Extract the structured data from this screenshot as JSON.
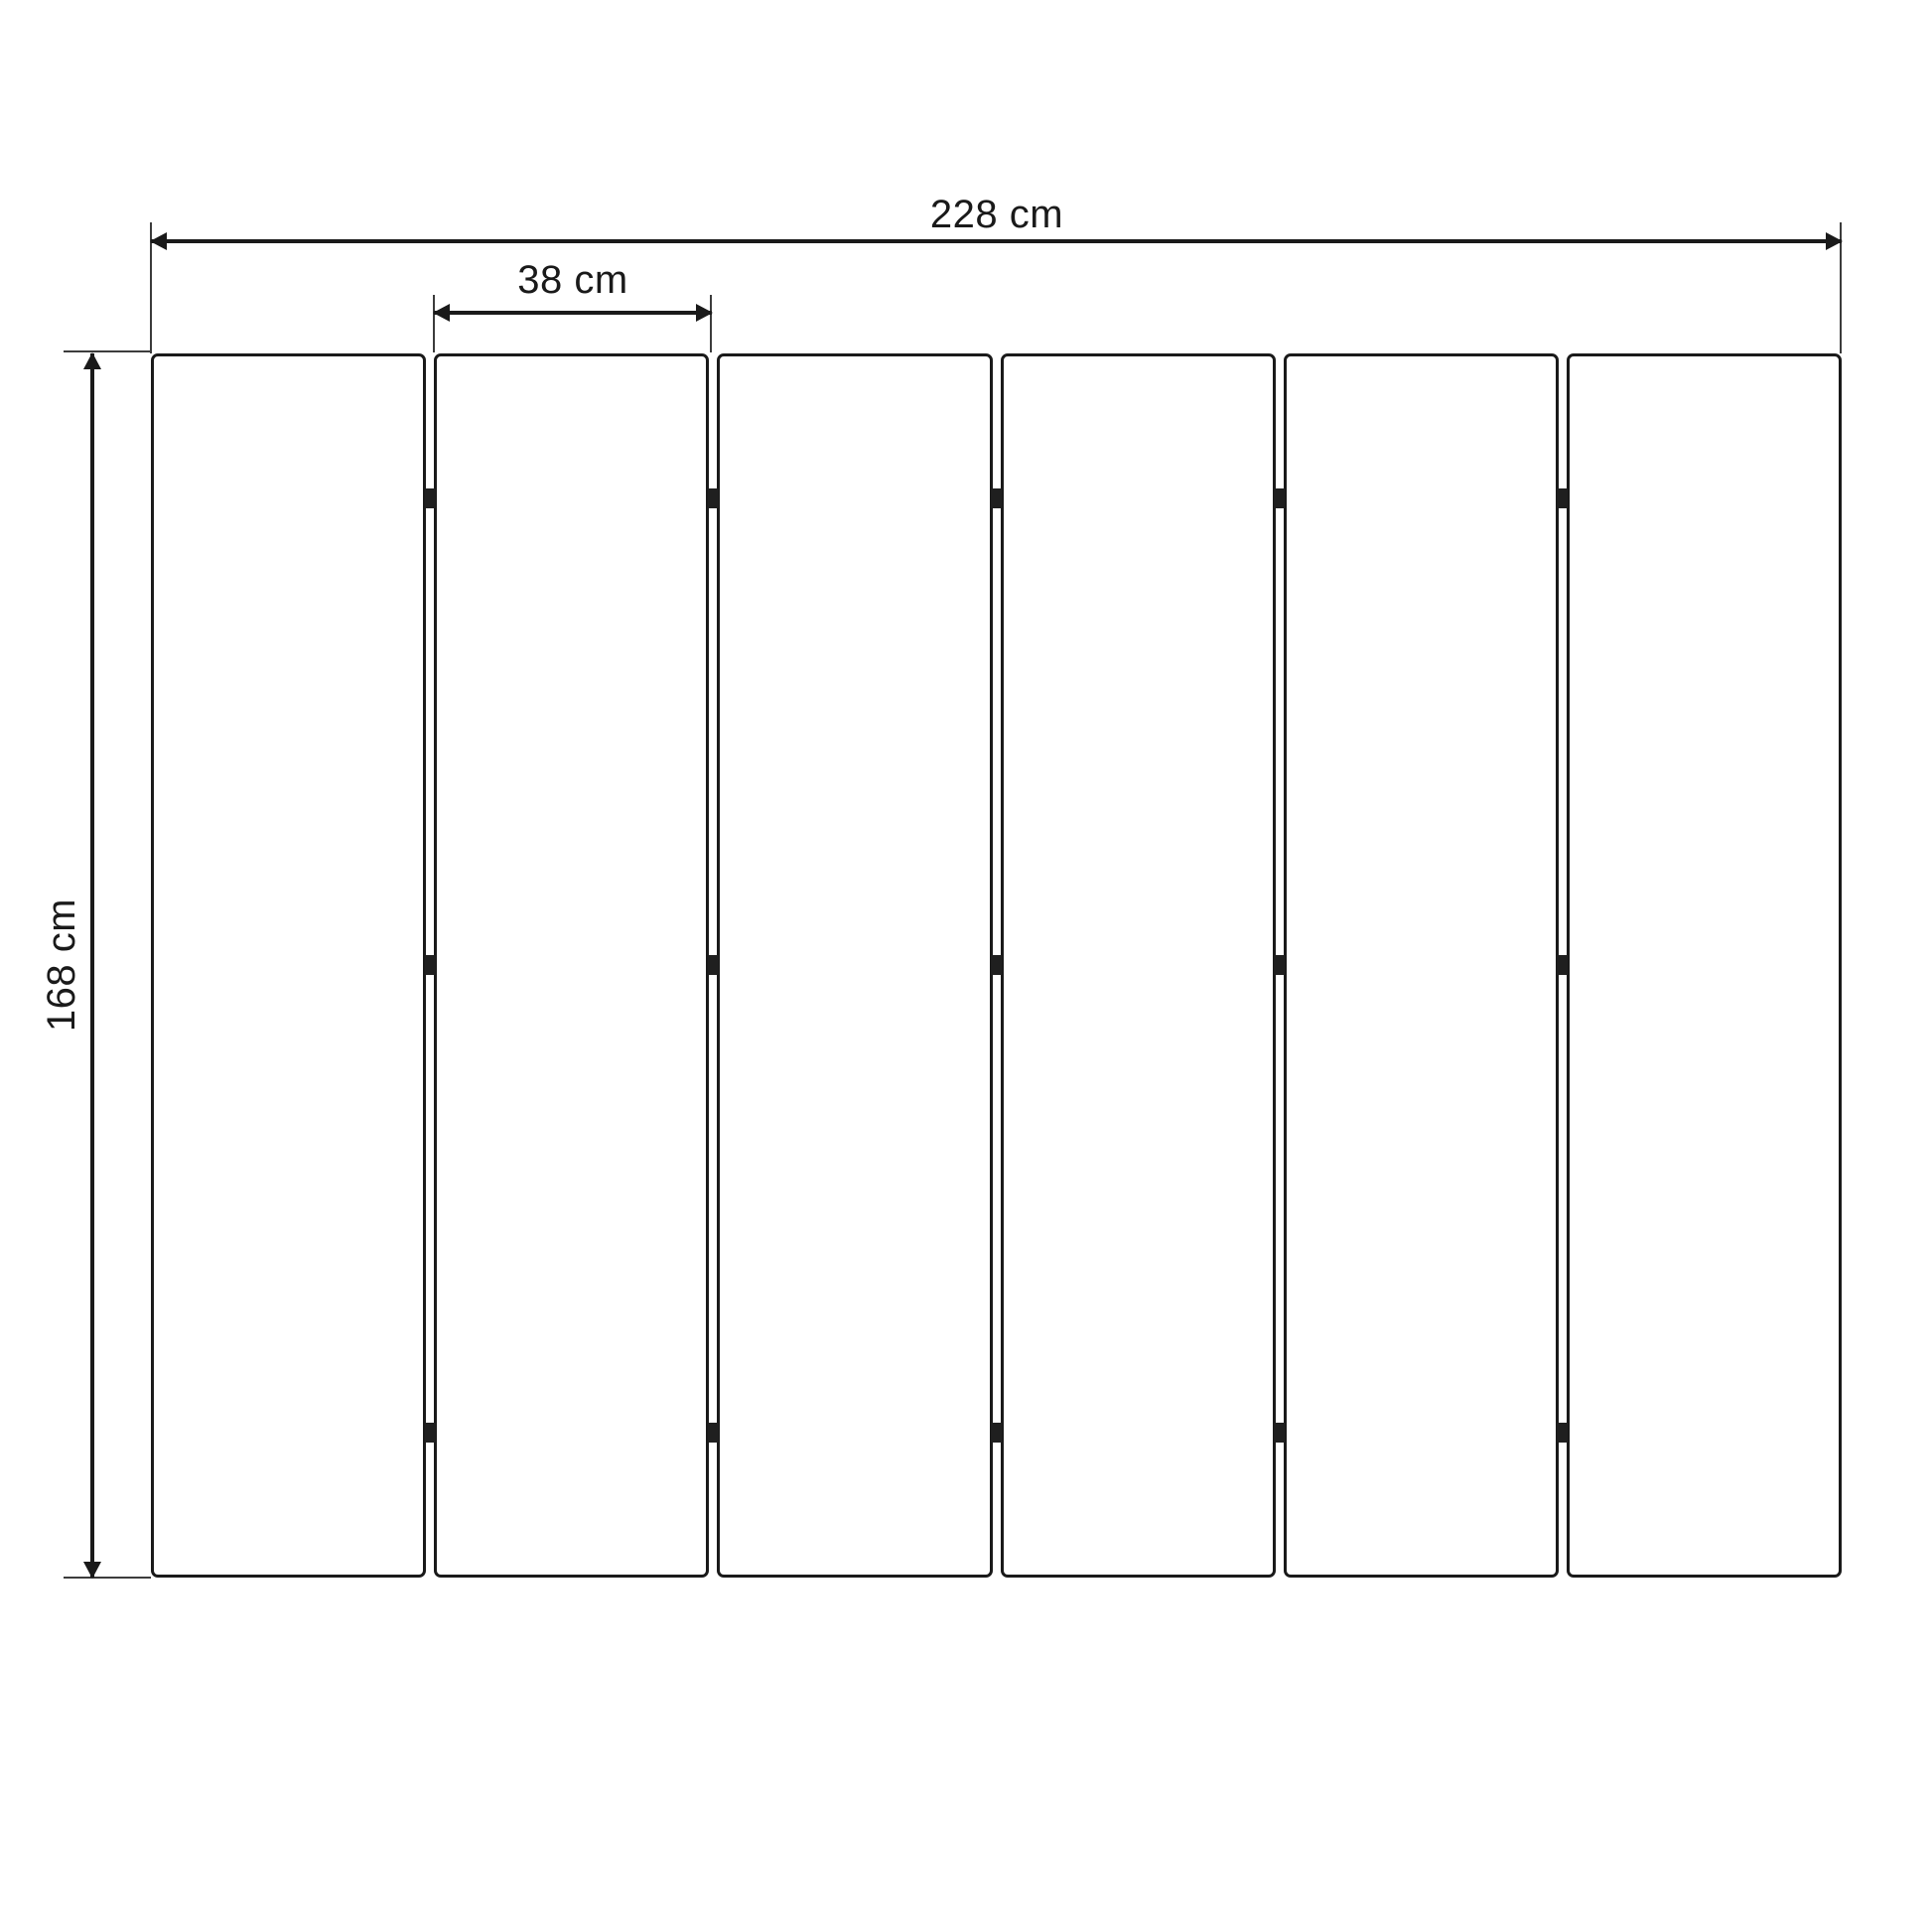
{
  "colors": {
    "background": "#ffffff",
    "line": "#1a1a1a",
    "extension_line": "#3c3c3c",
    "hinge_fill": "#1f1f1f"
  },
  "diagram": {
    "kind": "dimension-drawing",
    "panels": {
      "count": 6,
      "hinge_columns": 5,
      "hinge_rows": 3
    },
    "dimensions": {
      "total_width": "228 cm",
      "panel_width": "38 cm",
      "height": "168 cm"
    }
  }
}
